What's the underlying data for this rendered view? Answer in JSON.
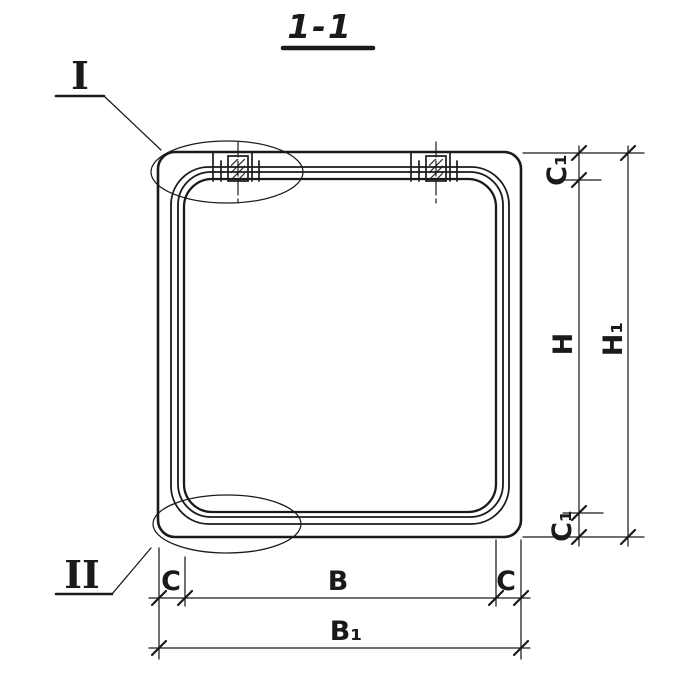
{
  "drawing": {
    "title": "1-1",
    "callouts": {
      "detail_1": "I",
      "detail_2": "II"
    },
    "dimensions": {
      "c1_top": "C₁",
      "h": "H",
      "h1": "H₁",
      "c1_bottom": "C₁",
      "c_left": "C",
      "b": "B",
      "c_right": "C",
      "b1": "B₁"
    },
    "colors": {
      "ink": "#1a1a1a",
      "paper": "#ffffff"
    }
  }
}
